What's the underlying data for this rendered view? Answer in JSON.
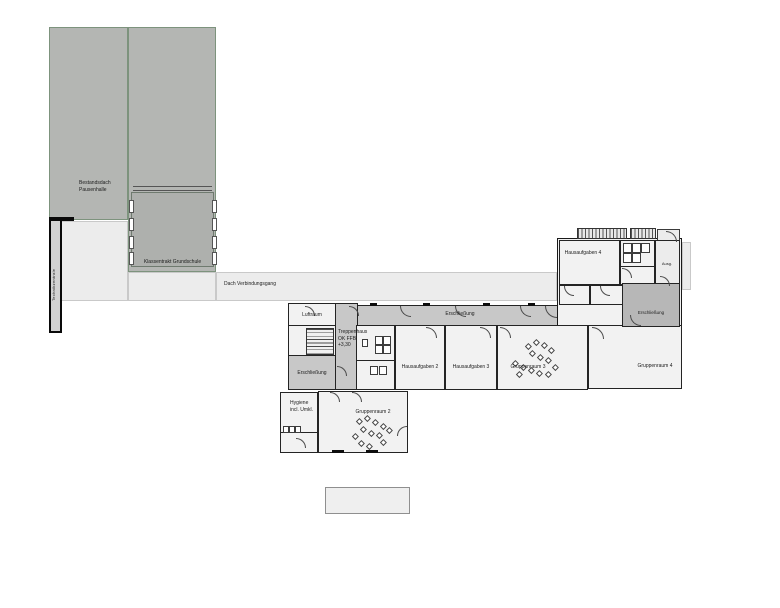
{
  "title": "Erdgeschoss Grundriss – Schulerweiterung",
  "labels": {
    "bestandsdach_line1": "Bestandsdach",
    "bestandsdach_line2": "Pausenhalle",
    "klassentrakt": "Klassentrakt Grundschule",
    "technikzentrale": "Technikzentrale",
    "dach_verbindungsgang": "Dach Verbindungsgang",
    "luftraum": "Luftraum",
    "treppenhaus_line1": "Treppenhaus",
    "treppenhaus_line2": "OK FFB",
    "treppenhaus_line3": "+3,30",
    "erschliessung_left": "Erschließung",
    "erschliessung_main": "Erschließung",
    "erschliessung_right": "Erschließung",
    "hygiene_line1": "Hygiene",
    "hygiene_line2": "incl. Umkl.",
    "gruppenraum2": "Gruppenraum 2",
    "gruppenraum3": "Gruppenraum 3",
    "gruppenraum4": "Gruppenraum 4",
    "hausaufgaben2": "Hausaufgaben 2",
    "hausaufgaben3": "Hausaufgaben 3",
    "hausaufgaben4": "Hausaufgaben 4",
    "ausgang": "Ausg."
  },
  "colors": {
    "canopy": "#b4b6b3",
    "classroom_block": "#aeb0ad",
    "walkway": "#ececec",
    "circulation": "#c8c8c8",
    "circulation_dark": "#b7b7b7",
    "room_fill": "#f2f2f2",
    "wall": "#1a1a1a"
  },
  "furniture": {
    "gruppenraum3_dots": [
      [
        526,
        344
      ],
      [
        534,
        340
      ],
      [
        542,
        343
      ],
      [
        549,
        348
      ],
      [
        530,
        351
      ],
      [
        538,
        355
      ],
      [
        546,
        358
      ],
      [
        513,
        361
      ],
      [
        521,
        365
      ],
      [
        529,
        368
      ],
      [
        537,
        371
      ],
      [
        553,
        365
      ],
      [
        546,
        372
      ],
      [
        517,
        372
      ]
    ],
    "gruppenraum2_dots": [
      [
        357,
        419
      ],
      [
        365,
        416
      ],
      [
        373,
        420
      ],
      [
        381,
        424
      ],
      [
        361,
        427
      ],
      [
        369,
        431
      ],
      [
        353,
        434
      ],
      [
        377,
        433
      ],
      [
        387,
        428
      ],
      [
        359,
        441
      ],
      [
        367,
        444
      ],
      [
        381,
        440
      ]
    ]
  }
}
